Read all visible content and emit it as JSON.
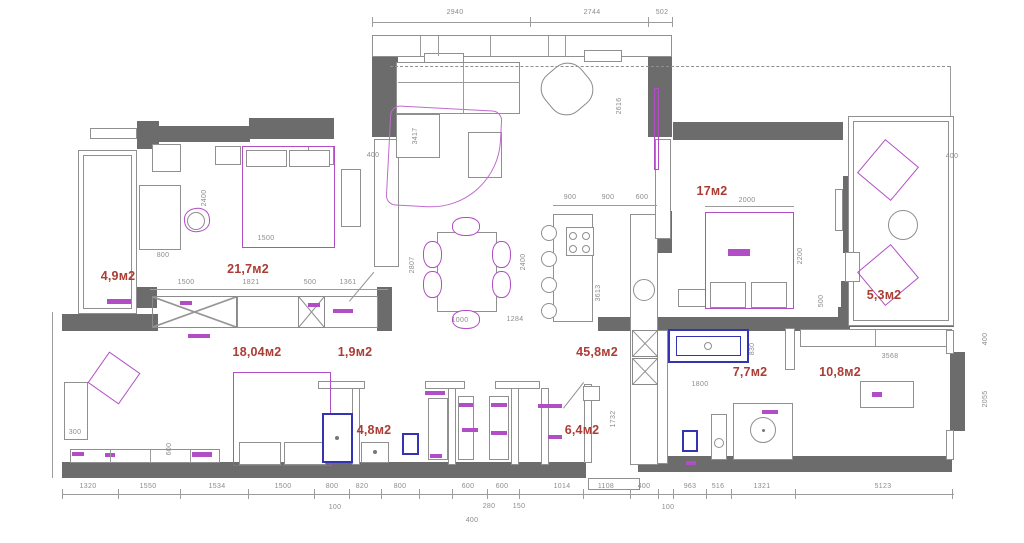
{
  "drawing": {
    "type_label": "apartment floor plan"
  },
  "colors": {
    "wall": "#6c6c6c",
    "furniture_magenta": "#b14ec6",
    "fixture_blue": "#3434b2",
    "area_label_red": "#ab3c34",
    "dimension_gray": "#8c8c8c",
    "background": "#ffffff"
  },
  "area_labels": [
    {
      "t": "4,9м2",
      "x": 118,
      "y": 276
    },
    {
      "t": "21,7м2",
      "x": 248,
      "y": 269
    },
    {
      "t": "17м2",
      "x": 712,
      "y": 191
    },
    {
      "t": "5,3м2",
      "x": 884,
      "y": 295
    },
    {
      "t": "45,8м2",
      "x": 597,
      "y": 352
    },
    {
      "t": "18,04м2",
      "x": 257,
      "y": 352
    },
    {
      "t": "1,9м2",
      "x": 355,
      "y": 352
    },
    {
      "t": "4,8м2",
      "x": 374,
      "y": 430
    },
    {
      "t": "6,4м2",
      "x": 582,
      "y": 430
    },
    {
      "t": "7,7м2",
      "x": 750,
      "y": 372
    },
    {
      "t": "10,8м2",
      "x": 840,
      "y": 372
    }
  ],
  "dim_labels": [
    {
      "t": "2940",
      "x": 455,
      "y": 13
    },
    {
      "t": "2744",
      "x": 592,
      "y": 13
    },
    {
      "t": "502",
      "x": 662,
      "y": 13
    },
    {
      "t": "1500",
      "x": 186,
      "y": 283
    },
    {
      "t": "1821",
      "x": 251,
      "y": 283
    },
    {
      "t": "500",
      "x": 310,
      "y": 283
    },
    {
      "t": "1361",
      "x": 348,
      "y": 283
    },
    {
      "t": "2400",
      "x": 205,
      "y": 198,
      "v": 1
    },
    {
      "t": "800",
      "x": 163,
      "y": 256
    },
    {
      "t": "1500",
      "x": 266,
      "y": 239
    },
    {
      "t": "400",
      "x": 373,
      "y": 156
    },
    {
      "t": "900",
      "x": 570,
      "y": 198
    },
    {
      "t": "900",
      "x": 608,
      "y": 198
    },
    {
      "t": "600",
      "x": 642,
      "y": 198
    },
    {
      "t": "2400",
      "x": 524,
      "y": 262,
      "v": 1
    },
    {
      "t": "3613",
      "x": 599,
      "y": 293,
      "v": 1
    },
    {
      "t": "2807",
      "x": 413,
      "y": 265,
      "v": 1
    },
    {
      "t": "1000",
      "x": 460,
      "y": 321
    },
    {
      "t": "1284",
      "x": 515,
      "y": 320
    },
    {
      "t": "3417",
      "x": 416,
      "y": 136,
      "v": 1
    },
    {
      "t": "2616",
      "x": 620,
      "y": 106,
      "v": 1
    },
    {
      "t": "2000",
      "x": 747,
      "y": 201
    },
    {
      "t": "2200",
      "x": 801,
      "y": 256,
      "v": 1
    },
    {
      "t": "500",
      "x": 822,
      "y": 301,
      "v": 1
    },
    {
      "t": "400",
      "x": 952,
      "y": 157
    },
    {
      "t": "1800",
      "x": 700,
      "y": 385
    },
    {
      "t": "830",
      "x": 753,
      "y": 349,
      "v": 1
    },
    {
      "t": "1732",
      "x": 614,
      "y": 419,
      "v": 1
    },
    {
      "t": "3568",
      "x": 890,
      "y": 357
    },
    {
      "t": "2055",
      "x": 986,
      "y": 399,
      "v": 1
    },
    {
      "t": "400",
      "x": 986,
      "y": 339,
      "v": 1
    },
    {
      "t": "300",
      "x": 75,
      "y": 433
    },
    {
      "t": "600",
      "x": 170,
      "y": 449,
      "v": 1
    },
    {
      "t": "1320",
      "x": 88,
      "y": 487
    },
    {
      "t": "1550",
      "x": 148,
      "y": 487
    },
    {
      "t": "1534",
      "x": 217,
      "y": 487
    },
    {
      "t": "1500",
      "x": 283,
      "y": 487
    },
    {
      "t": "800",
      "x": 332,
      "y": 487
    },
    {
      "t": "820",
      "x": 362,
      "y": 487
    },
    {
      "t": "800",
      "x": 400,
      "y": 487
    },
    {
      "t": "600",
      "x": 468,
      "y": 487
    },
    {
      "t": "600",
      "x": 502,
      "y": 487
    },
    {
      "t": "1014",
      "x": 562,
      "y": 487
    },
    {
      "t": "1108",
      "x": 606,
      "y": 487
    },
    {
      "t": "400",
      "x": 644,
      "y": 487
    },
    {
      "t": "963",
      "x": 690,
      "y": 487
    },
    {
      "t": "516",
      "x": 718,
      "y": 487
    },
    {
      "t": "1321",
      "x": 762,
      "y": 487
    },
    {
      "t": "5123",
      "x": 883,
      "y": 487
    },
    {
      "t": "100",
      "x": 335,
      "y": 508
    },
    {
      "t": "400",
      "x": 472,
      "y": 521
    },
    {
      "t": "280",
      "x": 489,
      "y": 507
    },
    {
      "t": "150",
      "x": 519,
      "y": 507
    },
    {
      "t": "100",
      "x": 668,
      "y": 508
    }
  ],
  "walls": [
    [
      372,
      55,
      26,
      82
    ],
    [
      648,
      55,
      24,
      82
    ],
    [
      137,
      121,
      22,
      28
    ],
    [
      158,
      126,
      92,
      16
    ],
    [
      249,
      118,
      85,
      21
    ],
    [
      133,
      287,
      24,
      21
    ],
    [
      62,
      314,
      96,
      17
    ],
    [
      377,
      287,
      15,
      44
    ],
    [
      62,
      462,
      524,
      16
    ],
    [
      638,
      456,
      314,
      16
    ],
    [
      673,
      122,
      170,
      18
    ],
    [
      843,
      176,
      19,
      77
    ],
    [
      841,
      281,
      22,
      26
    ],
    [
      838,
      307,
      116,
      20
    ],
    [
      598,
      317,
      252,
      14
    ],
    [
      655,
      211,
      17,
      42
    ],
    [
      950,
      352,
      15,
      79
    ]
  ],
  "thin_rects": [
    [
      372,
      35,
      300,
      22
    ],
    [
      424,
      53,
      40,
      11
    ],
    [
      584,
      50,
      38,
      12
    ],
    [
      78,
      150,
      59,
      164
    ],
    [
      83,
      155,
      49,
      154
    ],
    [
      90,
      128,
      47,
      11
    ],
    [
      215,
      146,
      26,
      19
    ],
    [
      308,
      146,
      26,
      19
    ],
    [
      152,
      144,
      29,
      28
    ],
    [
      139,
      185,
      42,
      65
    ],
    [
      341,
      169,
      20,
      58
    ],
    [
      374,
      139,
      25,
      128
    ],
    [
      237,
      296,
      62,
      32
    ],
    [
      324,
      296,
      54,
      32
    ],
    [
      64,
      382,
      24,
      58
    ],
    [
      70,
      449,
      150,
      14
    ],
    [
      318,
      381,
      47,
      8
    ],
    [
      425,
      381,
      40,
      8
    ],
    [
      495,
      381,
      45,
      8
    ],
    [
      352,
      388,
      8,
      77
    ],
    [
      448,
      388,
      8,
      77
    ],
    [
      511,
      388,
      8,
      77
    ],
    [
      541,
      388,
      8,
      77
    ],
    [
      584,
      384,
      8,
      79
    ],
    [
      428,
      398,
      20,
      62
    ],
    [
      458,
      396,
      16,
      64
    ],
    [
      489,
      396,
      20,
      64
    ],
    [
      583,
      386,
      17,
      15
    ],
    [
      361,
      442,
      28,
      21
    ],
    [
      733,
      403,
      60,
      57
    ],
    [
      711,
      414,
      16,
      46
    ],
    [
      785,
      328,
      10,
      42
    ],
    [
      656,
      330,
      12,
      134
    ],
    [
      630,
      214,
      28,
      251
    ],
    [
      553,
      214,
      40,
      108
    ],
    [
      566,
      227,
      28,
      29
    ],
    [
      437,
      232,
      60,
      80
    ],
    [
      468,
      132,
      34,
      46
    ],
    [
      396,
      62,
      124,
      52
    ],
    [
      396,
      114,
      44,
      44
    ],
    [
      655,
      139,
      16,
      100
    ],
    [
      678,
      289,
      28,
      18
    ],
    [
      710,
      282,
      36,
      26
    ],
    [
      751,
      282,
      36,
      26
    ],
    [
      835,
      189,
      8,
      42
    ],
    [
      848,
      116,
      106,
      210
    ],
    [
      853,
      121,
      96,
      200
    ],
    [
      845,
      252,
      15,
      30
    ],
    [
      800,
      329,
      152,
      18
    ],
    [
      860,
      381,
      54,
      27
    ],
    [
      946,
      330,
      8,
      24
    ],
    [
      946,
      430,
      8,
      30
    ],
    [
      588,
      478,
      52,
      12
    ],
    [
      246,
      150,
      41,
      17
    ],
    [
      289,
      150,
      41,
      17
    ],
    [
      239,
      442,
      42,
      23
    ],
    [
      284,
      442,
      42,
      23
    ]
  ],
  "gray_round": [
    [
      543,
      65,
      48,
      48,
      -40
    ]
  ],
  "magenta_rects": [
    [
      242,
      146,
      93,
      102
    ],
    [
      705,
      212,
      89,
      97
    ],
    [
      233,
      372,
      98,
      94
    ],
    [
      95,
      359,
      38,
      38,
      35
    ],
    [
      866,
      148,
      44,
      44,
      40
    ],
    [
      866,
      253,
      44,
      44,
      -40
    ],
    [
      654,
      88,
      5,
      82
    ]
  ],
  "magenta_round": [
    [
      452,
      217,
      28,
      19
    ],
    [
      452,
      310,
      28,
      19
    ],
    [
      423,
      241,
      19,
      27
    ],
    [
      423,
      271,
      19,
      27
    ],
    [
      492,
      241,
      19,
      27
    ],
    [
      492,
      271,
      19,
      27
    ],
    [
      184,
      208,
      26,
      24,
      -8
    ]
  ],
  "rug": [
    388,
    108,
    112,
    100,
    3
  ],
  "blue_rects": [
    [
      322,
      413,
      31,
      50
    ],
    [
      668,
      329,
      81,
      34
    ],
    [
      402,
      433,
      17,
      22
    ],
    [
      682,
      430,
      16,
      22
    ]
  ],
  "blue2_rects": [
    [
      676,
      336,
      65,
      20
    ]
  ],
  "hatch_boxes": [
    [
      152,
      296,
      85,
      32
    ],
    [
      298,
      296,
      27,
      32
    ],
    [
      632,
      330,
      26,
      27
    ],
    [
      632,
      358,
      26,
      27
    ]
  ],
  "circles": [
    {
      "x": 549,
      "y": 233,
      "r": 8
    },
    {
      "x": 549,
      "y": 259,
      "r": 8
    },
    {
      "x": 549,
      "y": 285,
      "r": 8
    },
    {
      "x": 549,
      "y": 311,
      "r": 8
    },
    {
      "x": 644,
      "y": 290,
      "r": 11
    },
    {
      "x": 573,
      "y": 236,
      "r": 4
    },
    {
      "x": 586,
      "y": 236,
      "r": 4
    },
    {
      "x": 573,
      "y": 249,
      "r": 4
    },
    {
      "x": 586,
      "y": 249,
      "r": 4
    },
    {
      "x": 763,
      "y": 430,
      "r": 13,
      "dot": 1
    },
    {
      "x": 903,
      "y": 225,
      "r": 15
    },
    {
      "x": 719,
      "y": 443,
      "r": 5
    },
    {
      "x": 708,
      "y": 346,
      "r": 4
    },
    {
      "x": 375,
      "y": 452,
      "r": 2,
      "fill": 1
    },
    {
      "x": 337,
      "y": 438,
      "r": 2,
      "fill": 1
    },
    {
      "x": 196,
      "y": 221,
      "r": 9
    }
  ],
  "mini_bars": [
    [
      180,
      301,
      12,
      4
    ],
    [
      188,
      334,
      22,
      4
    ],
    [
      308,
      303,
      12,
      4
    ],
    [
      333,
      309,
      20,
      4
    ],
    [
      425,
      391,
      20,
      4
    ],
    [
      459,
      403,
      14,
      4
    ],
    [
      491,
      403,
      16,
      4
    ],
    [
      462,
      428,
      16,
      4
    ],
    [
      491,
      431,
      16,
      4
    ],
    [
      430,
      454,
      12,
      4
    ],
    [
      548,
      435,
      14,
      4
    ],
    [
      538,
      404,
      24,
      4
    ],
    [
      72,
      452,
      12,
      4
    ],
    [
      105,
      453,
      10,
      4
    ],
    [
      192,
      452,
      20,
      5
    ],
    [
      728,
      249,
      22,
      7
    ],
    [
      872,
      392,
      10,
      5
    ],
    [
      686,
      461,
      10,
      4
    ],
    [
      107,
      299,
      24,
      5
    ],
    [
      762,
      410,
      16,
      4
    ]
  ],
  "solid_lines": [
    [
      372,
      22,
      300,
      0
    ],
    [
      62,
      494,
      892,
      0
    ],
    [
      150,
      289,
      238,
      0
    ],
    [
      553,
      205,
      104,
      0
    ],
    [
      705,
      206,
      89,
      0
    ],
    [
      950,
      66,
      0,
      50
    ],
    [
      52,
      312,
      0,
      166
    ],
    [
      398,
      82,
      122,
      0
    ],
    [
      463,
      63,
      0,
      50
    ],
    [
      110,
      450,
      0,
      13
    ],
    [
      150,
      450,
      0,
      13
    ],
    [
      190,
      450,
      0,
      13
    ],
    [
      420,
      36,
      0,
      20
    ],
    [
      438,
      36,
      0,
      20
    ],
    [
      490,
      36,
      0,
      20
    ],
    [
      548,
      36,
      0,
      20
    ],
    [
      565,
      36,
      0,
      20
    ],
    [
      875,
      330,
      0,
      16
    ]
  ],
  "top_ticks": [
    372,
    530,
    648,
    672
  ],
  "bottom_ticks": [
    62,
    118,
    180,
    248,
    314,
    349,
    381,
    419,
    452,
    487,
    519,
    583,
    630,
    658,
    673,
    706,
    731,
    795,
    952
  ],
  "dashed_lines": [
    [
      390,
      66,
      560
    ]
  ],
  "door_swings": [
    [
      349,
      301,
      38,
      -50
    ],
    [
      563,
      408,
      33,
      -52
    ]
  ]
}
